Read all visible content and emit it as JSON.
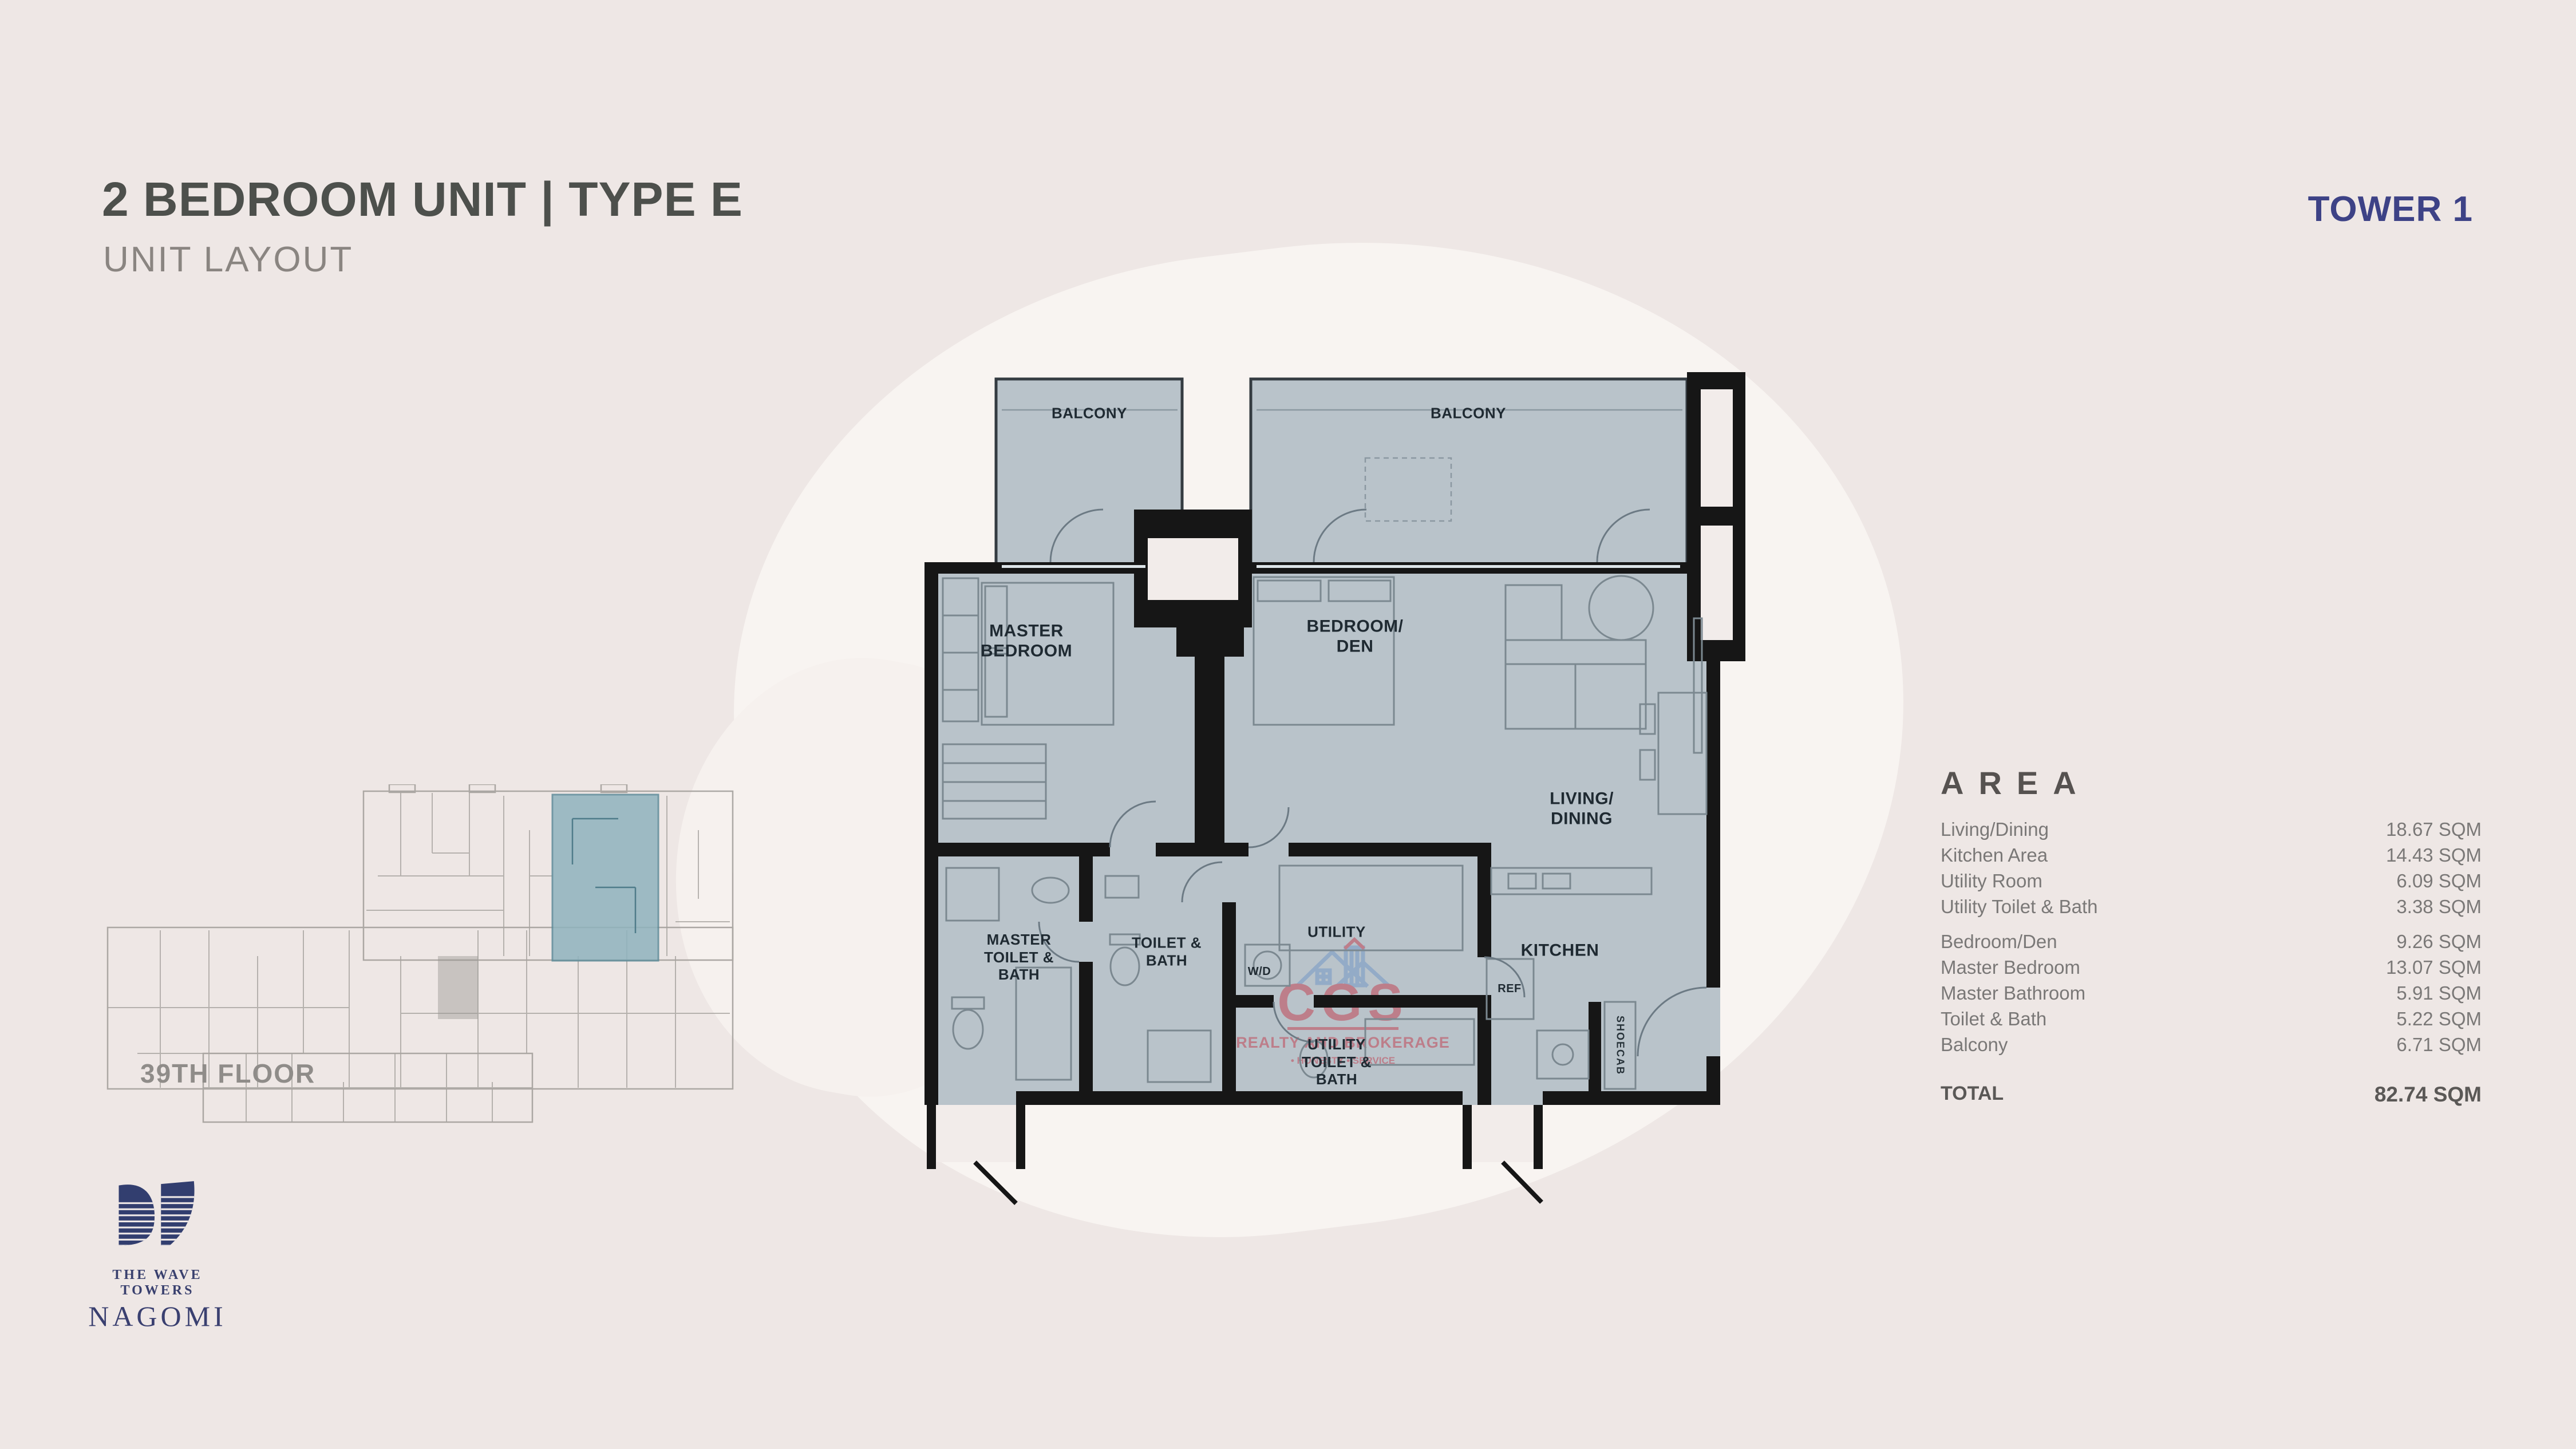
{
  "header": {
    "title": "2 BEDROOM UNIT | TYPE E",
    "subtitle": "UNIT LAYOUT",
    "tower": "TOWER 1"
  },
  "plan": {
    "balcony_left": "BALCONY",
    "balcony_right": "BALCONY",
    "rooms": {
      "master_bedroom": "MASTER\nBEDROOM",
      "bedroom_den": "BEDROOM/\nDEN",
      "living_dining": "LIVING/\nDINING",
      "master_toilet_bath": "MASTER\nTOILET &\nBATH",
      "toilet_bath": "TOILET &\nBATH",
      "utility": "UTILITY",
      "washer_dryer": "W/D",
      "kitchen": "KITCHEN",
      "refrigerator": "REF",
      "utility_toilet_bath": "UTILITY\nTOILET &\nBATH",
      "shoe_cabinet": "SHOECAB"
    }
  },
  "floorplate": {
    "label": "39TH FLOOR"
  },
  "watermark": {
    "brand": "CGS",
    "tagline": "REALTY AND BROKERAGE",
    "values": "• HONESTY   • SERVICE"
  },
  "logo": {
    "brand_line": "THE WAVE TOWERS",
    "wordmark": "NAGOMI"
  },
  "area": {
    "heading": "AREA",
    "rows": [
      {
        "label": "Living/Dining",
        "value": "18.67 SQM"
      },
      {
        "label": "Kitchen Area",
        "value": "14.43 SQM"
      },
      {
        "label": "Utility Room",
        "value": "6.09 SQM"
      },
      {
        "label": "Utility Toilet & Bath",
        "value": "3.38 SQM"
      },
      {
        "label": "Bedroom/Den",
        "value": "9.26 SQM"
      },
      {
        "label": "Master Bedroom",
        "value": "13.07 SQM"
      },
      {
        "label": "Master Bathroom",
        "value": "5.91 SQM"
      },
      {
        "label": "Toilet & Bath",
        "value": "5.22 SQM"
      },
      {
        "label": "Balcony",
        "value": "6.71 SQM"
      }
    ],
    "total_label": "TOTAL",
    "total_value": "82.74 SQM"
  },
  "colors": {
    "background": "#eee7e5",
    "floor_fill": "#b9c3ca",
    "wall": "#161616",
    "accent_navy": "#3d4286",
    "title_gray": "#4d504c",
    "highlight_teal": "#8fb3be",
    "watermark_red": "#c23b4c"
  }
}
